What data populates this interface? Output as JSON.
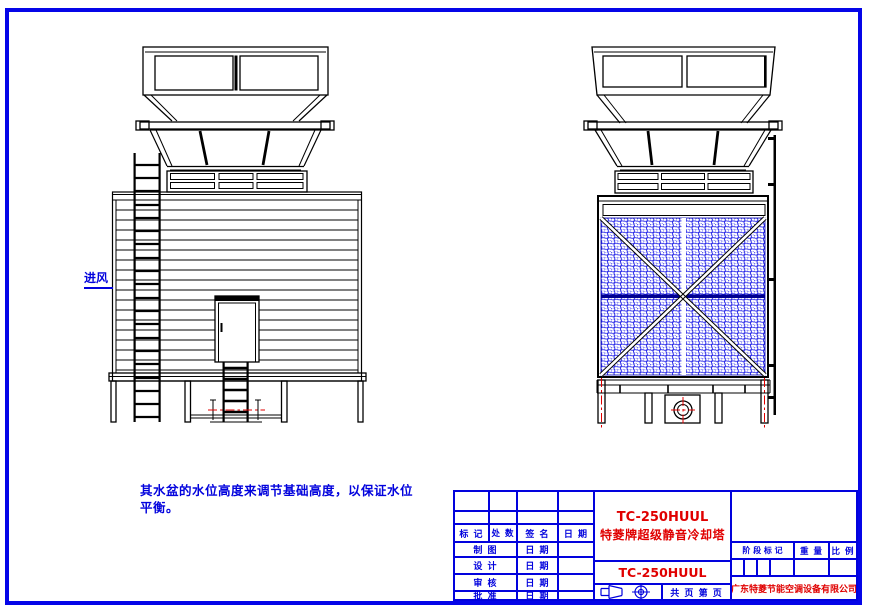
{
  "colors": {
    "frame_blue": "#0505e8",
    "table_blue": "#0202dd",
    "accent_red": "#e00000",
    "mesh_blue": "#1a1ae6",
    "line_black": "#000000"
  },
  "drawing": {
    "air_inlet_label": "进风",
    "note_line1": "其水盆的水位高度来调节基础高度，以保证水位",
    "note_line2": "平衡。"
  },
  "title_block": {
    "col_headers": [
      "标 记",
      "处 数",
      "签 名",
      "日 期"
    ],
    "sign_rows": [
      {
        "label": "制 图",
        "date": "日 期"
      },
      {
        "label": "设 计",
        "date": "日 期"
      },
      {
        "label": "审 核",
        "date": "日 期"
      },
      {
        "label": "批 准",
        "date": "日 期"
      }
    ],
    "product_model": "TC-250HUUL",
    "product_name": "特菱牌超级静音冷却塔",
    "model_repeat": "TC-250HUUL",
    "stage_mark_header": "阶 段 标 记",
    "weight_header": "重 量",
    "scale_header": "比 例",
    "sheet_label": "共 页 第 页",
    "company": "广东特菱节能空调设备有限公司"
  }
}
